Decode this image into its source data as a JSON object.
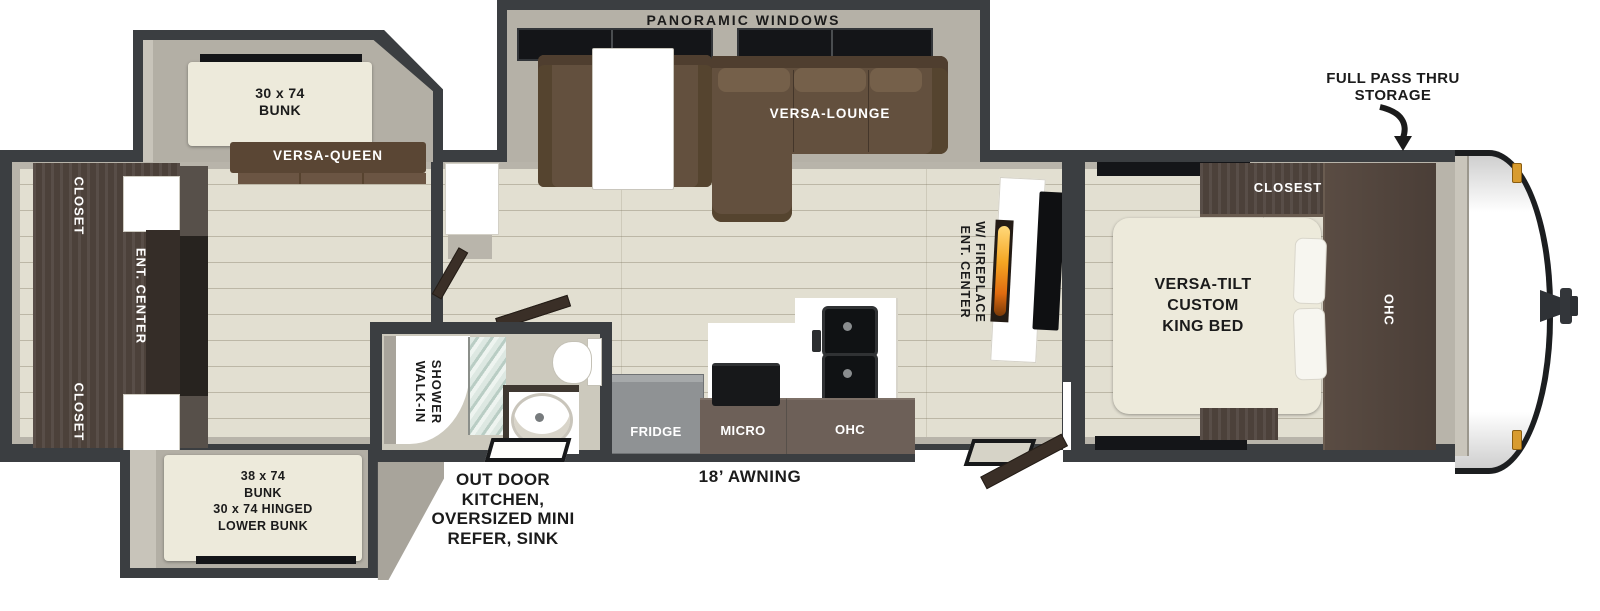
{
  "diagram": {
    "front": {
      "storage_note": {
        "line1": "FULL PASS THRU",
        "line2": "STORAGE"
      }
    },
    "bedroom": {
      "bed_line1": "VERSA-TILT",
      "bed_line2": "CUSTOM",
      "bed_line3": "KING BED",
      "closet": "CLOSEST",
      "ohc": "OHC"
    },
    "living": {
      "slide": "PANORAMIC WINDOWS",
      "lounge": "VERSA-LOUNGE",
      "ent_center_line1": "ENT. CENTER",
      "ent_center_line2": "W/ FIREPLACE"
    },
    "kitchen": {
      "fridge": "FRIDGE",
      "micro": "MICRO",
      "ohc": "OHC"
    },
    "bathroom": {
      "shower_line1": "WALK-IN",
      "shower_line2": "SHOWER"
    },
    "bunkroom": {
      "top_bunk_line1": "30 x 74",
      "top_bunk_line2": "BUNK",
      "sofa": "VERSA-QUEEN",
      "closet_top": "CLOSET",
      "ent_center": "ENT. CENTER",
      "closet_bottom": "CLOSET",
      "lower_bunk_line1": "38 x 74",
      "lower_bunk_line2": "BUNK",
      "lower_bunk_line3": "30 x 74 HINGED",
      "lower_bunk_line4": "LOWER BUNK"
    },
    "exterior": {
      "awning": "18’ AWNING",
      "outdoor_kitchen_line1": "OUT DOOR",
      "outdoor_kitchen_line2": "KITCHEN,",
      "outdoor_kitchen_line3": "OVERSIZED MINI",
      "outdoor_kitchen_line4": "REFER, SINK"
    }
  },
  "colors": {
    "wall": "#3b3e41",
    "slide_interior": "#b3afa5",
    "floor": "#e2dfd1",
    "dark_wood": "#4c413a",
    "sofa": "#63503e",
    "mattress": "#edeadb",
    "counter": "#ffffff",
    "fridge": "#8f9294",
    "cabinet": "#6d6058",
    "flame_orange": "#f5a623",
    "marker_light": "#d89b2e",
    "window_black": "#141518"
  }
}
